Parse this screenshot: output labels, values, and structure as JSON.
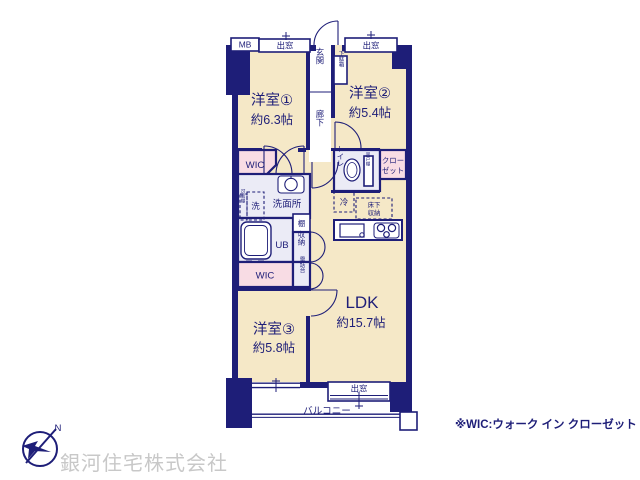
{
  "colors": {
    "wall": "#1e1e78",
    "room": "#f5e8c7",
    "pink": "#f8dce4",
    "water": "#ebebf6",
    "paper": "#ffffff",
    "company-grey": "#c8c8c8"
  },
  "plan": {
    "rooms": {
      "y1": {
        "name": "洋室①",
        "size": "約6.3帖"
      },
      "y2": {
        "name": "洋室②",
        "size": "約5.4帖"
      },
      "y3": {
        "name": "洋室③",
        "size": "約5.8帖"
      },
      "ldk": {
        "name": "LDK",
        "size": "約15.7帖"
      }
    },
    "labels": {
      "mb": "MB",
      "bay_window": "出窓",
      "entrance": "玄関",
      "shoe_box": "下駄箱",
      "corridor": "廊下",
      "wic": "WIC",
      "toilet": "トイレ",
      "hanging_cupboard": "吊戸棚",
      "closet_lines": [
        "クロー",
        "ゼット"
      ],
      "fridge": "冷",
      "washroom": "洗面所",
      "washer": "洗",
      "movable_shelf": "可動棚",
      "unit_bath": "UB",
      "shelf": "棚",
      "storage": "収納",
      "phone_stand": "電話台",
      "underfloor_lines": [
        "床下",
        "収納"
      ],
      "balcony": "バルコニー"
    }
  },
  "footer": {
    "company_name": "銀河住宅株式会社",
    "wic_note": "※WIC:ウォーク イン クローゼット",
    "compass_north": "N"
  }
}
